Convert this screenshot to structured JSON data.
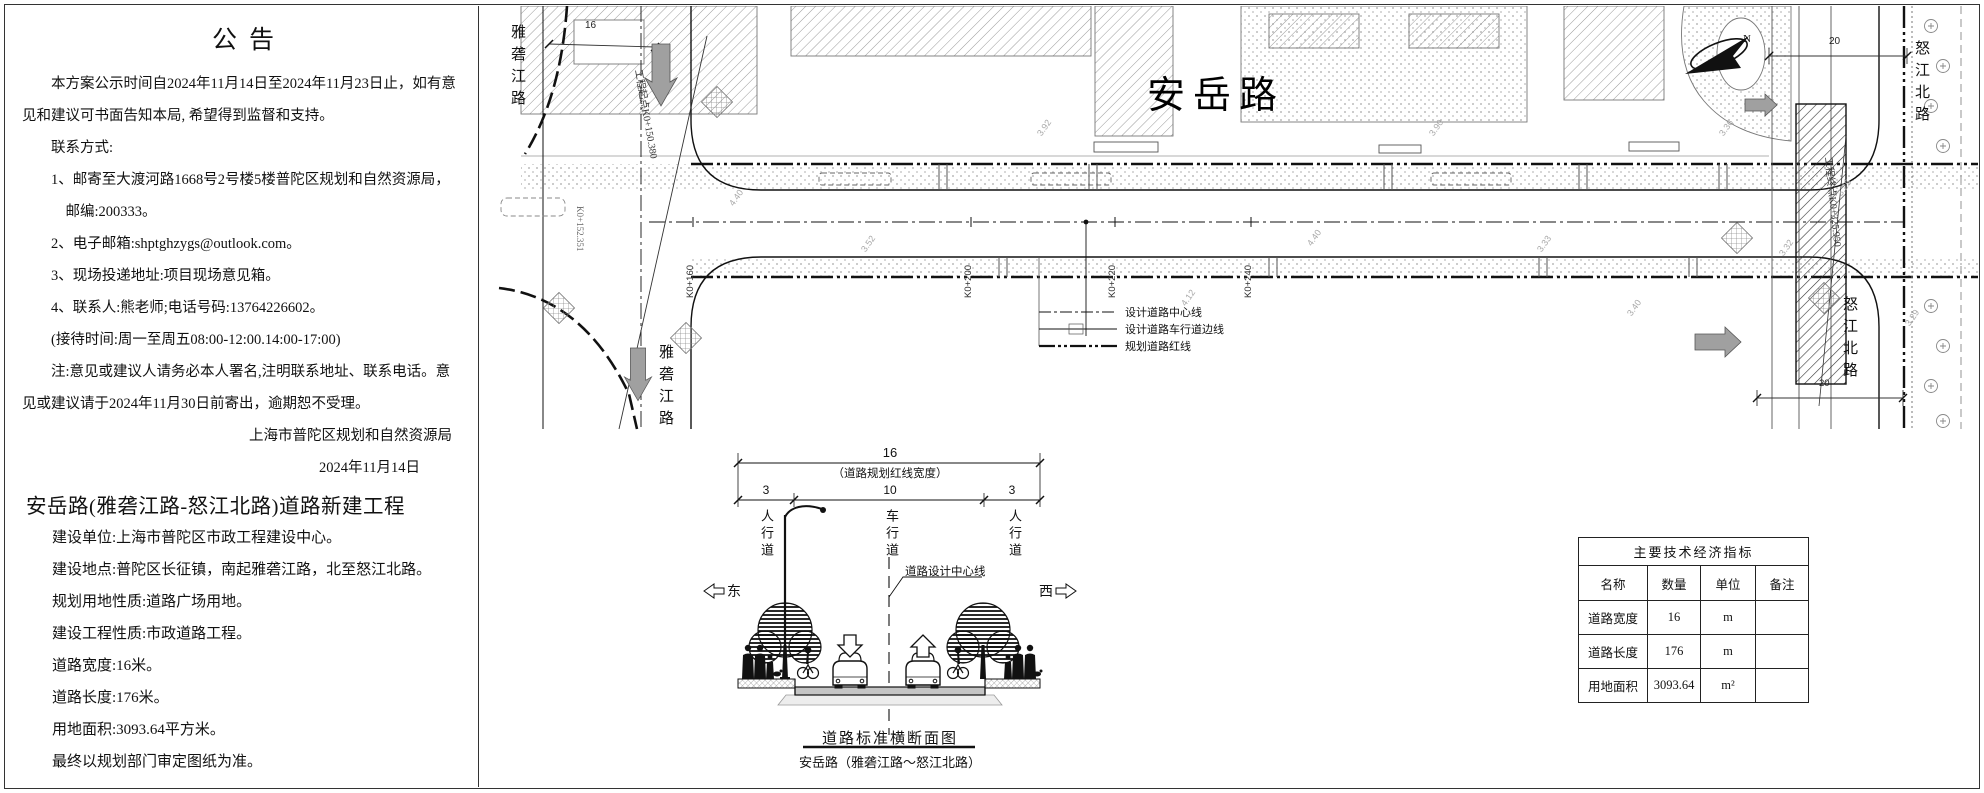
{
  "notice": {
    "title": "公告",
    "body": [
      "本方案公示时间自2024年11月14日至2024年11月23日止，如有意见和建议可书面告知本局, 希望得到监督和支持。",
      "联系方式:",
      "1、邮寄至大渡河路1668号2号楼5楼普陀区规划和自然资源局，",
      "邮编:200333。",
      "2、电子邮箱:shptghzygs@outlook.com。",
      "3、现场投递地址:项目现场意见箱。",
      "4、联系人:熊老师;电话号码:13764226602。",
      "(接待时间:周一至周五08:00-12:00.14:00-17:00)",
      "注:意见或建议人请务必本人署名,注明联系地址、联系电话。意见或建议请于2024年11月30日前寄出，逾期恕不受理。"
    ],
    "signature": "上海市普陀区规划和自然资源局",
    "date": "2024年11月14日",
    "project_title": "安岳路(雅砻江路-怒江北路)道路新建工程",
    "details": [
      "建设单位:上海市普陀区市政工程建设中心。",
      "建设地点:普陀区长征镇，南起雅砻江路，北至怒江北路。",
      "规划用地性质:道路广场用地。",
      "建设工程性质:市政道路工程。",
      "道路宽度:16米。",
      "道路长度:176米。",
      "用地面积:3093.64平方米。",
      "最终以规划部门审定图纸为准。"
    ]
  },
  "plan": {
    "road_label": "安岳路",
    "west_road_label": "雅砻江路",
    "east_road_label": "怒江北路",
    "north_mark": "N",
    "start_point_label": "工程起点K0+150.380",
    "end_point_label": "工程终点K0+325.950",
    "edge_station": "K0+152.351",
    "stations": [
      "K0+160",
      "K0+200",
      "K0+220",
      "K0+240"
    ],
    "legend": [
      "设计道路中心线",
      "设计道路车行道边线",
      "规划道路红线"
    ],
    "dim_west": "16",
    "dim_east_top": "20",
    "dim_east_bottom": "20",
    "spot_elevations": [
      "4.40",
      "3.92",
      "4.12",
      "4.40",
      "3.90",
      "3.33",
      "3.40",
      "3.36",
      "3.32",
      "3.29",
      "3.52",
      "3.25"
    ]
  },
  "section": {
    "dim_total": "16",
    "dim_total_note": "（道路规划红线宽度）",
    "dim_left": "3",
    "dim_center": "10",
    "dim_right": "3",
    "lane_left": "人行道",
    "lane_center": "车行道",
    "lane_right": "人行道",
    "centerline_label": "道路设计中心线",
    "dir_east": "东",
    "dir_west": "西",
    "title": "道路标准横断面图",
    "subtitle": "安岳路（雅砻江路～怒江北路）"
  },
  "table": {
    "title": "主要技术经济指标",
    "headers": [
      "名称",
      "数量",
      "单位",
      "备注"
    ],
    "rows": [
      {
        "name": "道路宽度",
        "qty": "16",
        "unit": "m",
        "note": ""
      },
      {
        "name": "道路长度",
        "qty": "176",
        "unit": "m",
        "note": ""
      },
      {
        "name": "用地面积",
        "qty": "3093.64",
        "unit": "m²",
        "note": ""
      }
    ]
  },
  "colors": {
    "line": "#111111",
    "light_line": "#999999",
    "gray_fill": "#a0a0a0"
  }
}
